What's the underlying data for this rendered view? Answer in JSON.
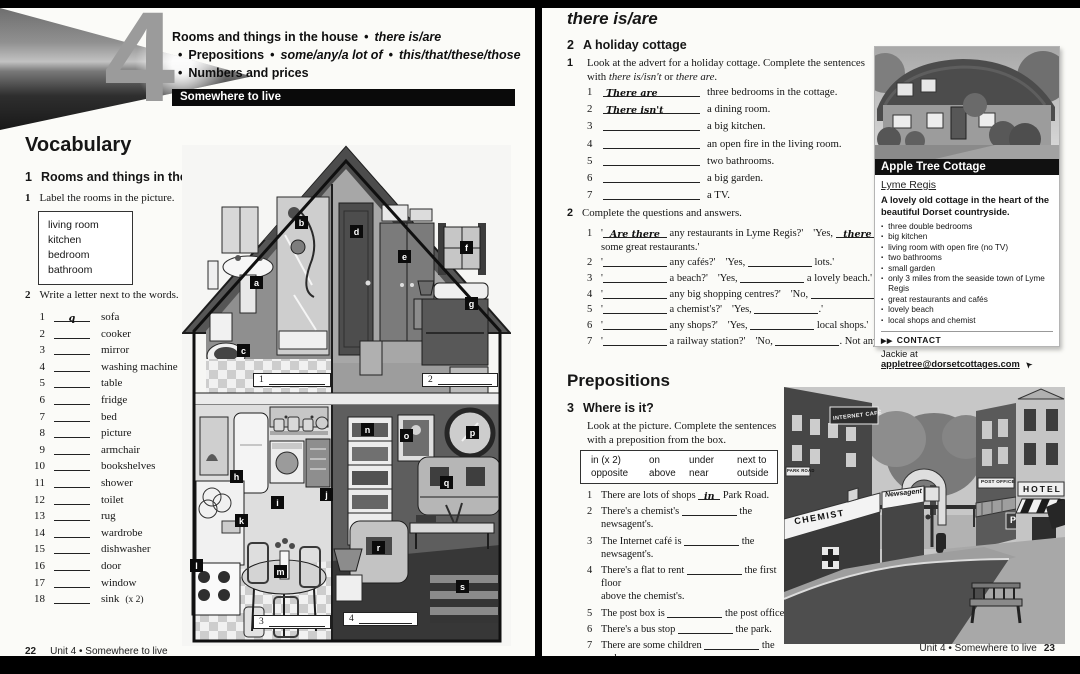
{
  "bullet": "•",
  "icons": {
    "cursor": "➤",
    "arrows": "▶▶",
    "square_bullet": "▪"
  },
  "unit": {
    "number": "4",
    "line1_a": "Rooms and things in the house",
    "line1_b": "there is/are",
    "line2_a": "Prepositions",
    "line2_b": "some/any/a lot of",
    "line2_c": "this/that/these/those",
    "line3": "Numbers and prices",
    "banner": "Somewhere to live"
  },
  "vocabulary": {
    "title": "Vocabulary",
    "section_num": "1",
    "section_title": "Rooms and things in the house",
    "ex1_num": "1",
    "ex1_text": "Label the rooms in the picture.",
    "word_box": [
      "living room",
      "kitchen",
      "bedroom",
      "bathroom"
    ],
    "ex2_num": "2",
    "ex2_text": "Write a letter next to the words.",
    "words": [
      {
        "num": "1",
        "ans": "q",
        "word": "sofa",
        "note": ""
      },
      {
        "num": "2",
        "ans": "",
        "word": "cooker",
        "note": ""
      },
      {
        "num": "3",
        "ans": "",
        "word": "mirror",
        "note": ""
      },
      {
        "num": "4",
        "ans": "",
        "word": "washing machine",
        "note": ""
      },
      {
        "num": "5",
        "ans": "",
        "word": "table",
        "note": ""
      },
      {
        "num": "6",
        "ans": "",
        "word": "fridge",
        "note": ""
      },
      {
        "num": "7",
        "ans": "",
        "word": "bed",
        "note": ""
      },
      {
        "num": "8",
        "ans": "",
        "word": "picture",
        "note": ""
      },
      {
        "num": "9",
        "ans": "",
        "word": "armchair",
        "note": ""
      },
      {
        "num": "10",
        "ans": "",
        "word": "bookshelves",
        "note": ""
      },
      {
        "num": "11",
        "ans": "",
        "word": "shower",
        "note": ""
      },
      {
        "num": "12",
        "ans": "",
        "word": "toilet",
        "note": ""
      },
      {
        "num": "13",
        "ans": "",
        "word": "rug",
        "note": ""
      },
      {
        "num": "14",
        "ans": "",
        "word": "wardrobe",
        "note": ""
      },
      {
        "num": "15",
        "ans": "",
        "word": "dishwasher",
        "note": ""
      },
      {
        "num": "16",
        "ans": "",
        "word": "door",
        "note": ""
      },
      {
        "num": "17",
        "ans": "",
        "word": "window",
        "note": ""
      },
      {
        "num": "18",
        "ans": "",
        "word": "sink",
        "note": "(x 2)"
      }
    ]
  },
  "house": {
    "tags": [
      {
        "letter": "a"
      },
      {
        "letter": "b"
      },
      {
        "letter": "c"
      },
      {
        "letter": "d"
      },
      {
        "letter": "e"
      },
      {
        "letter": "f"
      },
      {
        "letter": "g"
      },
      {
        "letter": "h"
      },
      {
        "letter": "i"
      },
      {
        "letter": "j"
      },
      {
        "letter": "k"
      },
      {
        "letter": "l"
      },
      {
        "letter": "m"
      },
      {
        "letter": "n"
      },
      {
        "letter": "o"
      },
      {
        "letter": "p"
      },
      {
        "letter": "q"
      },
      {
        "letter": "r"
      },
      {
        "letter": "s"
      }
    ],
    "slots": [
      {
        "num": "1"
      },
      {
        "num": "2"
      },
      {
        "num": "3"
      },
      {
        "num": "4"
      }
    ]
  },
  "there_is_are": {
    "title": "there is/are",
    "section_num": "2",
    "section_title": "A holiday cottage",
    "ex1_num": "1",
    "ex1_line1": "Look at the advert for a holiday cottage. Complete the sentences",
    "ex1_line2_pre": "with ",
    "ex1_line2_it1": "there is/isn't",
    "ex1_line2_mid": " or ",
    "ex1_line2_it2": "there are",
    "ex1_line2_post": ".",
    "ex1_items": [
      {
        "num": "1",
        "ans": "There are",
        "text": "three bedrooms in the cottage."
      },
      {
        "num": "2",
        "ans": "There isn't",
        "text": "a dining room."
      },
      {
        "num": "3",
        "ans": "",
        "text": "a big kitchen."
      },
      {
        "num": "4",
        "ans": "",
        "text": "an open fire in the living room."
      },
      {
        "num": "5",
        "ans": "",
        "text": "two bathrooms."
      },
      {
        "num": "6",
        "ans": "",
        "text": "a big garden."
      },
      {
        "num": "7",
        "ans": "",
        "text": "a TV."
      }
    ],
    "ex2_num": "2",
    "ex2_text": "Complete the questions and answers.",
    "quote": "'",
    "ex2_items": [
      {
        "num": "1",
        "q_ans": "Are there",
        "q_rest": "any restaurants in Lyme Regis?'",
        "a_lead": "'Yes,",
        "a_ans": "there are",
        "a_rest": "some great restaurants.'"
      },
      {
        "num": "2",
        "q_ans": "",
        "q_rest": "any cafés?'",
        "a_lead": "'Yes,",
        "a_ans": "",
        "a_rest": "lots.'"
      },
      {
        "num": "3",
        "q_ans": "",
        "q_rest": "a beach?'",
        "a_lead": "'Yes,",
        "a_ans": "",
        "a_rest": "a lovely beach.'"
      },
      {
        "num": "4",
        "q_ans": "",
        "q_rest": "any big shopping centres?'",
        "a_lead": "'No,",
        "a_ans": "",
        "a_rest": ".'"
      },
      {
        "num": "5",
        "q_ans": "",
        "q_rest": "a chemist's?'",
        "a_lead": "'Yes,",
        "a_ans": "",
        "a_rest": ".'"
      },
      {
        "num": "6",
        "q_ans": "",
        "q_rest": "any shops?'",
        "a_lead": "'Yes,",
        "a_ans": "",
        "a_rest": "local shops.'"
      },
      {
        "num": "7",
        "q_ans": "",
        "q_rest": "a railway station?'",
        "a_lead": "'No,",
        "a_ans": "",
        "a_rest": ". Not any more.'"
      }
    ]
  },
  "advert": {
    "title": "Apple Tree Cottage",
    "location": "Lyme Regis",
    "tagline": "A lovely old cottage in the heart of the beautiful Dorset countryside.",
    "bullets": [
      "three double bedrooms",
      "big kitchen",
      "living room with open fire (no TV)",
      "two bathrooms",
      "small garden",
      "only 3 miles from the seaside town of Lyme Regis",
      "great restaurants and cafés",
      "lovely beach",
      "local shops and chemist"
    ],
    "contact_label": "CONTACT",
    "contact_pre": "Jackie at",
    "contact_email": "appletree@dorsetcottages.com"
  },
  "prepositions": {
    "title": "Prepositions",
    "section_num": "3",
    "section_title": "Where is it?",
    "instr_line1": "Look at the picture. Complete the sentences",
    "instr_line2": "with a preposition from the box.",
    "box": [
      "in (x 2)",
      "on",
      "under",
      "next to",
      "opposite",
      "above",
      "near",
      "outside"
    ],
    "items": [
      {
        "num": "1",
        "before": "There are lots of shops",
        "ans": "in",
        "after": "Park Road.",
        "after2": ""
      },
      {
        "num": "2",
        "before": "There's a chemist's",
        "ans": "",
        "after": "the newsagent's.",
        "after2": ""
      },
      {
        "num": "3",
        "before": "The Internet café is",
        "ans": "",
        "after": "the newsagent's.",
        "after2": ""
      },
      {
        "num": "4",
        "before": "There's a flat to rent",
        "ans": "",
        "after": "the first floor",
        "after2": "above the chemist's."
      },
      {
        "num": "5",
        "before": "The post box is",
        "ans": "",
        "after": "the post office.",
        "after2": ""
      },
      {
        "num": "6",
        "before": "There's a bus stop",
        "ans": "",
        "after": "the park.",
        "after2": ""
      },
      {
        "num": "7",
        "before": "There are some children",
        "ans": "",
        "after": "the park.",
        "after2": ""
      },
      {
        "num": "8",
        "before": "There's a bench",
        "ans": "",
        "after": "the chemist's.",
        "after2": ""
      },
      {
        "num": "9",
        "before": "The car park is",
        "ans": "",
        "after": "the hotel.",
        "after2": ""
      }
    ]
  },
  "street": {
    "chemist": "CHEMIST",
    "newsagent": "Newsagent",
    "internet_cafe": "INTERNET CAFÉ",
    "park_road": "PARK ROAD",
    "post_office": "POST OFFICE",
    "hotel": "HOTEL",
    "parking": "P"
  },
  "footers": {
    "left_page_num": "22",
    "left_text": "Unit 4  •  Somewhere to live",
    "right_text": "Unit 4  •  Somewhere to live",
    "right_page_num": "23"
  }
}
